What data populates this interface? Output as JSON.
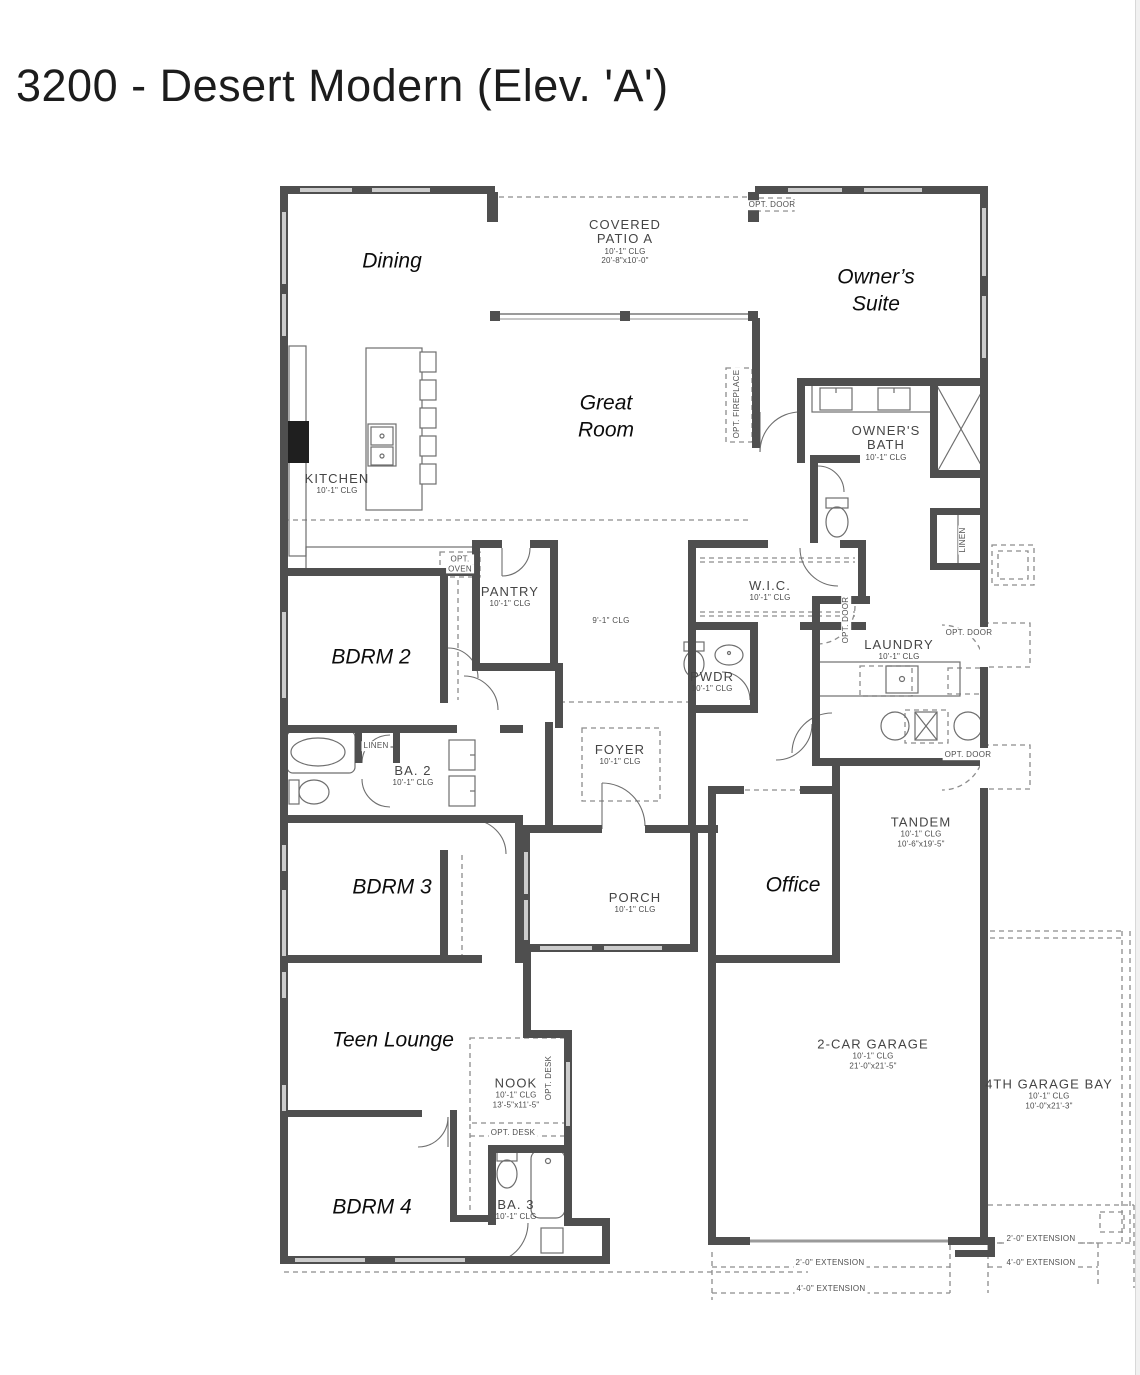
{
  "page": {
    "title": "3200 - Desert Modern (Elev. 'A')"
  },
  "floor_plan": {
    "labels": [
      {
        "id": "dining",
        "style": "annotation",
        "x": 392,
        "y": 261,
        "lines": [
          "Dining"
        ]
      },
      {
        "id": "owners-suite",
        "style": "annotation",
        "x": 876,
        "y": 291,
        "lines": [
          "Owner’s",
          "Suite"
        ]
      },
      {
        "id": "great-room",
        "style": "annotation",
        "x": 606,
        "y": 417,
        "lines": [
          "Great",
          "Room"
        ]
      },
      {
        "id": "bdrm-2",
        "style": "annotation",
        "x": 371,
        "y": 657,
        "lines": [
          "BDRM 2"
        ]
      },
      {
        "id": "bdrm-3",
        "style": "annotation",
        "x": 392,
        "y": 887,
        "lines": [
          "BDRM 3"
        ]
      },
      {
        "id": "office",
        "style": "annotation",
        "x": 793,
        "y": 885,
        "lines": [
          "Office"
        ]
      },
      {
        "id": "teen-lounge",
        "style": "annotation",
        "x": 393,
        "y": 1040,
        "lines": [
          "Teen Lounge"
        ]
      },
      {
        "id": "bdrm-4",
        "style": "annotation",
        "x": 372,
        "y": 1207,
        "lines": [
          "BDRM 4"
        ]
      },
      {
        "id": "covered-patio",
        "style": "arch",
        "x": 625,
        "y": 242,
        "lines": [
          "COVERED",
          "PATIO A"
        ],
        "sub": [
          "10'-1\" CLG",
          "20'-8\"x10'-0\""
        ]
      },
      {
        "id": "kitchen",
        "style": "arch",
        "x": 337,
        "y": 484,
        "lines": [
          "KITCHEN"
        ],
        "sub": [
          "10'-1\" CLG"
        ]
      },
      {
        "id": "owners-bath",
        "style": "arch",
        "x": 886,
        "y": 443,
        "lines": [
          "OWNER'S",
          "BATH"
        ],
        "sub": [
          "10'-1\" CLG"
        ]
      },
      {
        "id": "pantry",
        "style": "arch",
        "x": 510,
        "y": 597,
        "lines": [
          "PANTRY"
        ],
        "sub": [
          "10'-1\" CLG"
        ]
      },
      {
        "id": "wic",
        "style": "arch",
        "x": 770,
        "y": 591,
        "lines": [
          "W.I.C."
        ],
        "sub": [
          "10'-1\" CLG"
        ]
      },
      {
        "id": "laundry",
        "style": "arch",
        "x": 899,
        "y": 650,
        "lines": [
          "LAUNDRY"
        ],
        "sub": [
          "10'-1\" CLG"
        ]
      },
      {
        "id": "pwdr",
        "style": "arch",
        "x": 712,
        "y": 682,
        "lines": [
          "PWDR"
        ],
        "sub": [
          "10'-1\" CLG"
        ]
      },
      {
        "id": "foyer",
        "style": "arch",
        "x": 620,
        "y": 755,
        "lines": [
          "FOYER"
        ],
        "sub": [
          "10'-1\" CLG"
        ]
      },
      {
        "id": "ba-2",
        "style": "arch",
        "x": 413,
        "y": 776,
        "lines": [
          "BA. 2"
        ],
        "sub": [
          "10'-1\" CLG"
        ]
      },
      {
        "id": "tandem",
        "style": "arch",
        "x": 921,
        "y": 832,
        "lines": [
          "TANDEM"
        ],
        "sub": [
          "10'-1\" CLG",
          "10'-6\"x19'-5\""
        ]
      },
      {
        "id": "porch",
        "style": "arch",
        "x": 635,
        "y": 903,
        "lines": [
          "PORCH"
        ],
        "sub": [
          "10'-1\" CLG"
        ]
      },
      {
        "id": "nook",
        "style": "arch",
        "x": 516,
        "y": 1093,
        "lines": [
          "NOOK"
        ],
        "sub": [
          "10'-1\" CLG",
          "13'-5\"x11'-5\""
        ]
      },
      {
        "id": "two-car-garage",
        "style": "arch",
        "x": 873,
        "y": 1054,
        "lines": [
          "2-CAR GARAGE"
        ],
        "sub": [
          "10'-1\" CLG",
          "21'-0\"x21'-5\""
        ]
      },
      {
        "id": "fourth-garage-bay",
        "style": "arch",
        "x": 1049,
        "y": 1094,
        "lines": [
          "4TH GARAGE BAY"
        ],
        "sub": [
          "10'-1\" CLG",
          "10'-0\"x21'-3\""
        ]
      },
      {
        "id": "ba-3",
        "style": "arch",
        "x": 516,
        "y": 1210,
        "lines": [
          "BA. 3"
        ],
        "sub": [
          "10'-1\" CLG"
        ]
      },
      {
        "id": "hall-ceiling",
        "style": "small",
        "x": 611,
        "y": 621,
        "lines": [
          "9'-1\" CLG"
        ]
      },
      {
        "id": "opt-door-patio",
        "style": "small",
        "x": 772,
        "y": 205,
        "lines": [
          "OPT. DOOR"
        ]
      },
      {
        "id": "opt-oven",
        "style": "small",
        "x": 460,
        "y": 564,
        "lines": [
          "OPT.",
          "OVEN"
        ]
      },
      {
        "id": "opt-fireplace",
        "style": "small",
        "rotate": -90,
        "x": 737,
        "y": 404,
        "lines": [
          "OPT. FIREPLACE"
        ]
      },
      {
        "id": "linen-owners",
        "style": "small",
        "rotate": -90,
        "x": 963,
        "y": 540,
        "lines": [
          "LINEN"
        ]
      },
      {
        "id": "linen-ba2",
        "style": "small",
        "x": 376,
        "y": 746,
        "lines": [
          "LINEN"
        ]
      },
      {
        "id": "opt-door-laundry-closet",
        "style": "small",
        "rotate": -90,
        "x": 846,
        "y": 620,
        "lines": [
          "OPT. DOOR"
        ]
      },
      {
        "id": "opt-door-laundry-upper",
        "style": "small",
        "x": 969,
        "y": 633,
        "lines": [
          "OPT. DOOR"
        ]
      },
      {
        "id": "opt-door-laundry-lower",
        "style": "small",
        "x": 968,
        "y": 755,
        "lines": [
          "OPT. DOOR"
        ]
      },
      {
        "id": "opt-desk-vertical",
        "style": "small",
        "rotate": -90,
        "x": 549,
        "y": 1078,
        "lines": [
          "OPT. DESK"
        ]
      },
      {
        "id": "opt-desk-horizontal",
        "style": "small",
        "x": 513,
        "y": 1133,
        "lines": [
          "OPT. DESK"
        ]
      },
      {
        "id": "extension-2ft-garage",
        "style": "small",
        "x": 830,
        "y": 1263,
        "lines": [
          "2'-0\" EXTENSION"
        ]
      },
      {
        "id": "extension-4ft-garage",
        "style": "small",
        "x": 831,
        "y": 1289,
        "lines": [
          "4'-0\" EXTENSION"
        ]
      },
      {
        "id": "extension-2ft-bay",
        "style": "small",
        "x": 1041,
        "y": 1239,
        "lines": [
          "2'-0\" EXTENSION"
        ]
      },
      {
        "id": "extension-4ft-bay",
        "style": "small",
        "x": 1041,
        "y": 1263,
        "lines": [
          "4'-0\" EXTENSION"
        ]
      }
    ]
  }
}
